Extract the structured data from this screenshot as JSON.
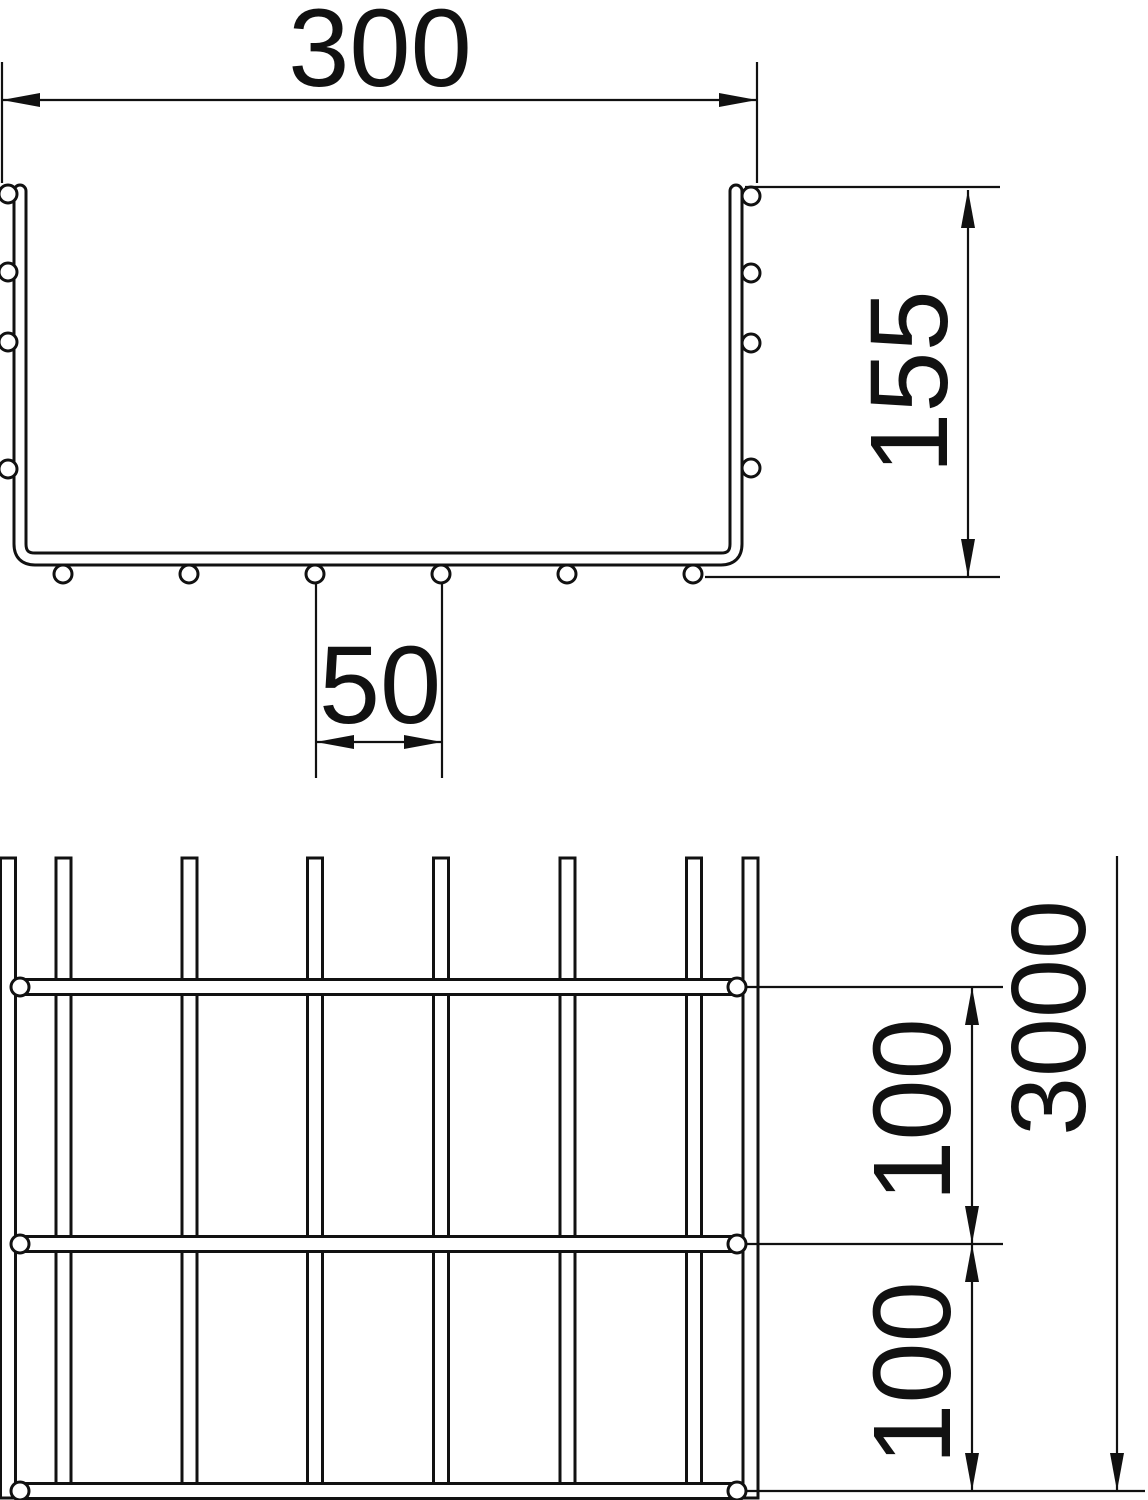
{
  "drawing": {
    "cross_section": {
      "width": "300",
      "height": "155",
      "bottom_wire_spacing": "50"
    },
    "plan": {
      "length": "3000",
      "rung_spacing_upper": "100",
      "rung_spacing_lower": "100"
    },
    "colors": {
      "line": "#111111",
      "background": "#ffffff"
    }
  }
}
